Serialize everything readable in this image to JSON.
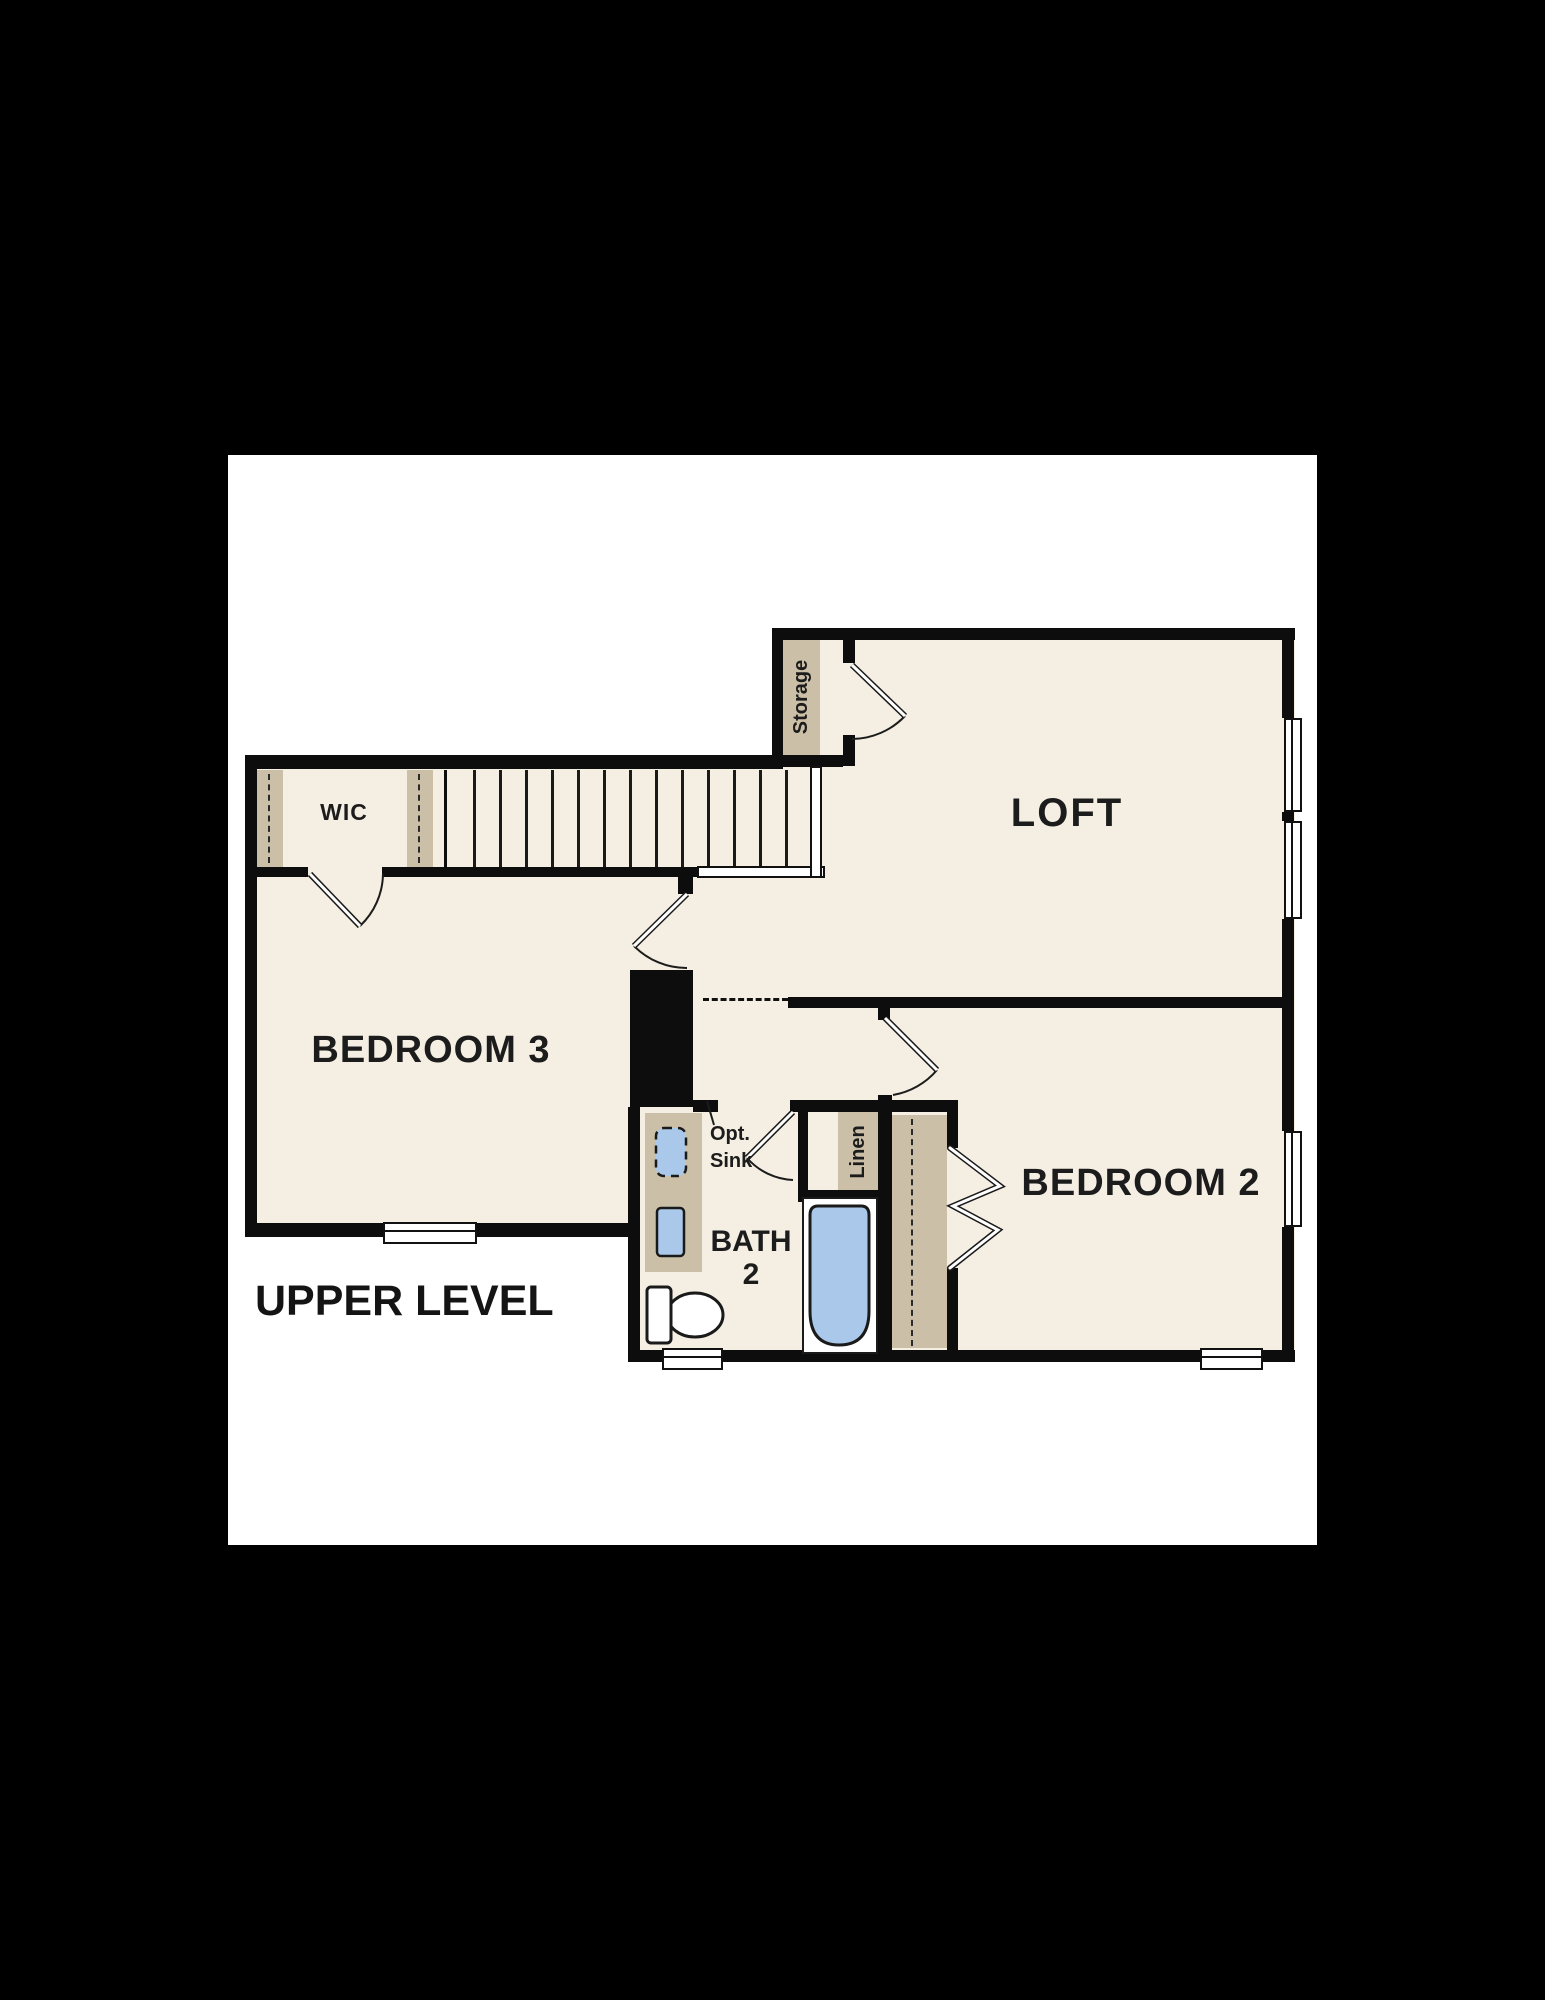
{
  "scene": {
    "background_color": "#000000",
    "sheet_color": "#ffffff"
  },
  "plan": {
    "floor_label": "UPPER LEVEL",
    "colors": {
      "floor": "#f5efe3",
      "wall": "#0d0d0d",
      "cabinet_tan": "#cbbfa7",
      "fixture_blue": "#aac9ea",
      "label_text": "#1c1c1c"
    },
    "labels": {
      "loft": "LOFT",
      "bedroom3": "BEDROOM 3",
      "bedroom2": "BEDROOM 2",
      "bath_line1": "BATH",
      "bath_line2": "2",
      "wic": "WIC",
      "storage": "Storage",
      "linen": "Linen",
      "opt_sink_line1": "Opt.",
      "opt_sink_line2": "Sink"
    },
    "symbols": {
      "doors": "quarter-arc swing doors",
      "closet_doors": "bifold chevrons",
      "windows": "white sill rectangles (6 total)",
      "stairs": "parallel tread lines with landing rail",
      "fixtures": [
        "vanity with optional sink",
        "sink",
        "toilet",
        "bathtub"
      ]
    }
  }
}
